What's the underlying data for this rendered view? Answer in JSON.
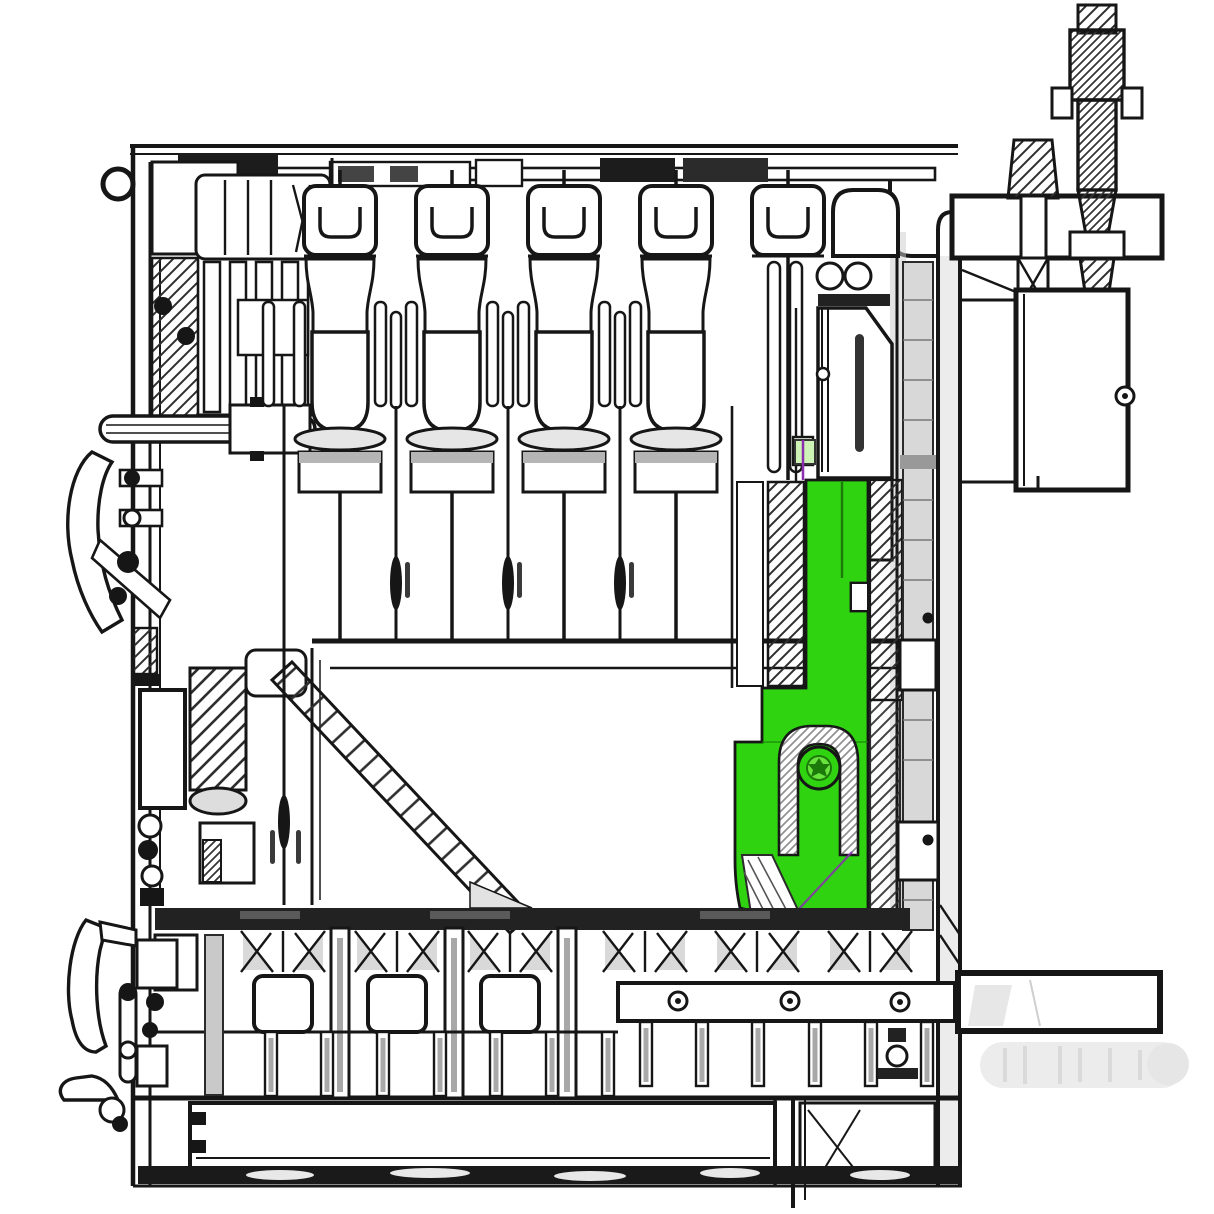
{
  "diagram": {
    "alt": "Sectional technical line drawing of a machine assembly with one component highlighted in green",
    "kind": "cross-section parts diagram",
    "text_labels": []
  },
  "colors": {
    "line": "#161616",
    "mid_line": "#2b2b2b",
    "highlight": "#2fd310",
    "highlight_light": "#6ae23e",
    "highlight_dark": "#1c7a0a",
    "highlight_tint": "#cdf2b6",
    "accent_purple": "#8a2fae",
    "shade_gray": "#b5b5b5",
    "soft_gray": "#d9d9d9",
    "ghost_gray": "#e9e9e9",
    "dark_fill": "#1c1c1c"
  },
  "structure": {
    "top_cylinder_units": 5,
    "top_end_slab_units": 1,
    "gap_spindles": 3,
    "bottom_funnel_boxes": 3,
    "bottom_right_funnels": 3,
    "bolt_holes_in_bar": 3,
    "left_levers": 2,
    "threaded_rods_top_right": 2
  },
  "highlighted_part": {
    "name": "selected-lever-bracket",
    "state": "highlighted",
    "pivot_bolts": 1
  }
}
